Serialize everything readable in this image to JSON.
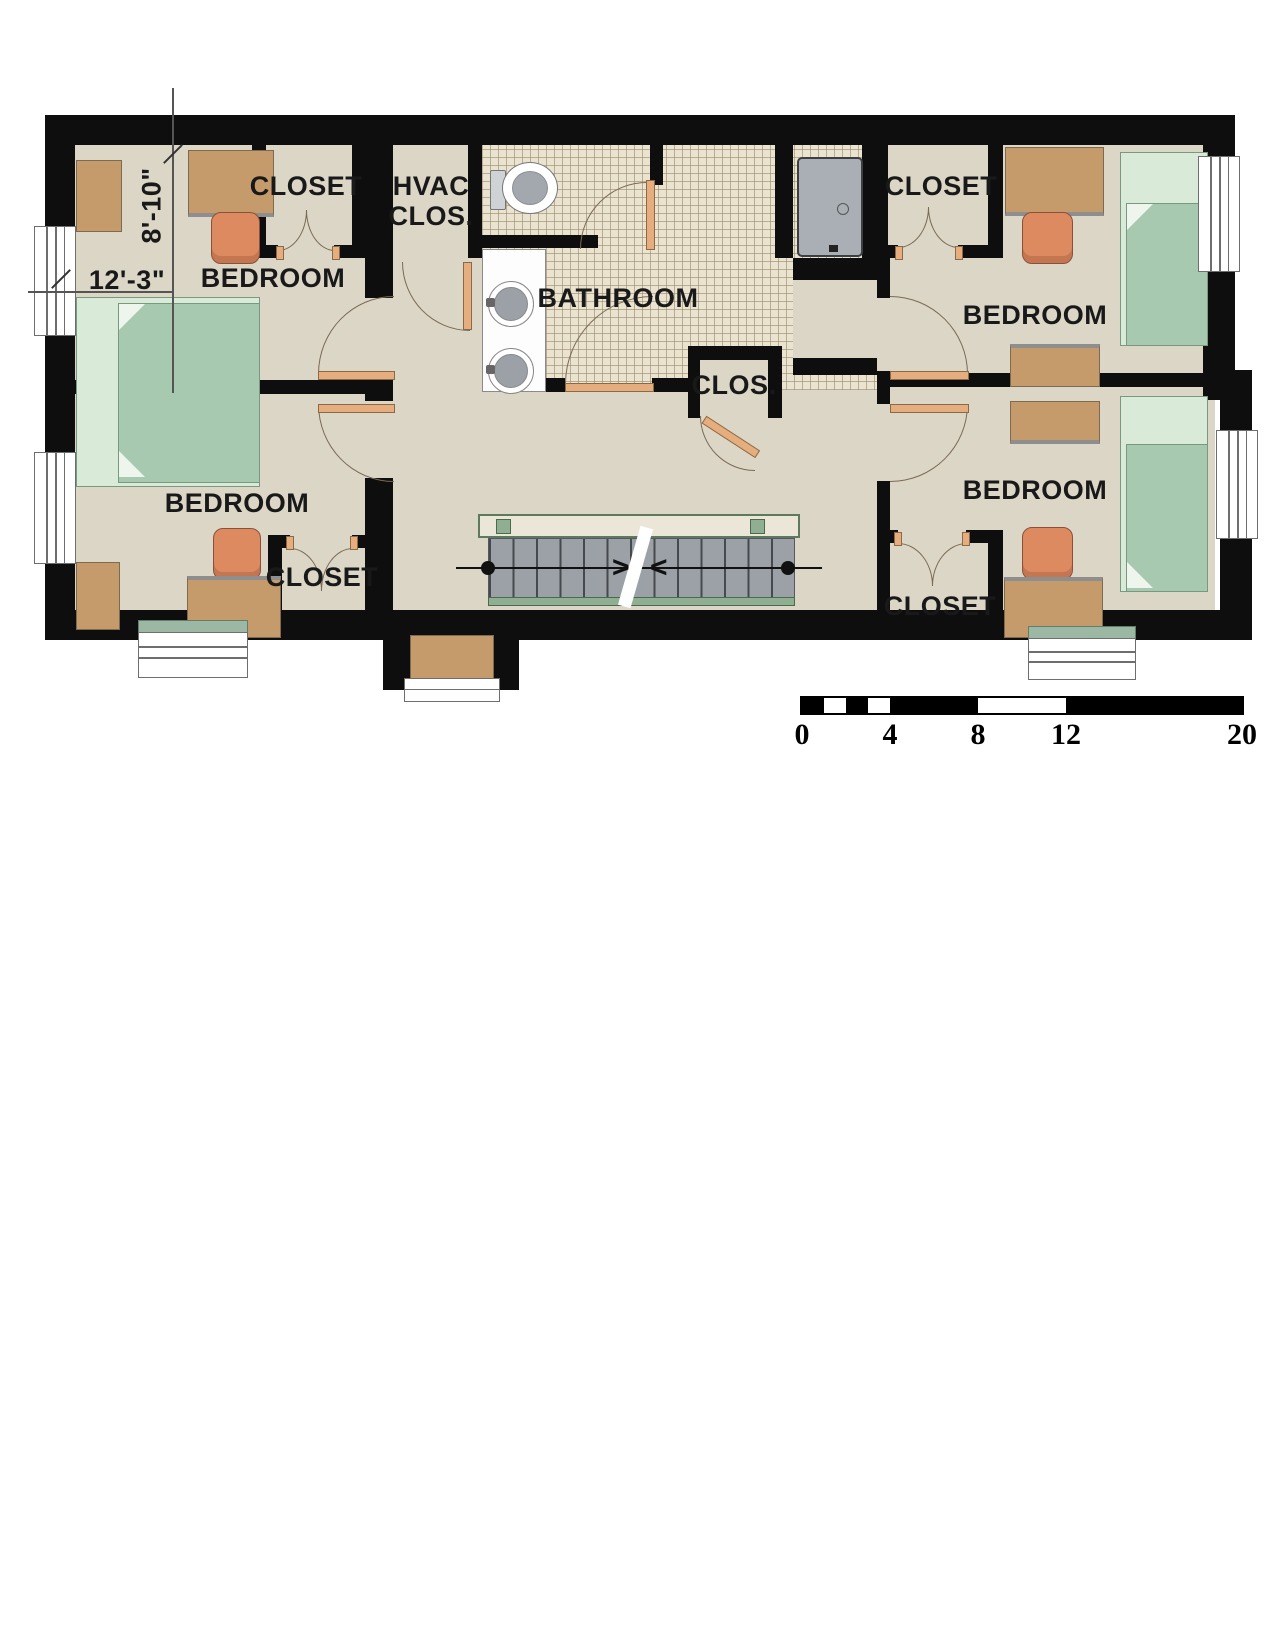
{
  "theme": {
    "wall": "#0e0e0e",
    "floor": "#dcd6c7",
    "tile": "#eae3d0",
    "bedlight": "#d9ebd8",
    "beddark": "#a7c9b0",
    "bedborder": "#79997e",
    "desk": "#c69b6c",
    "chair": "#de8a61",
    "chairborder": "#8a513a",
    "door": "#e6ae7e",
    "doorborder": "#8a6a45",
    "stair": "#9ba1a6",
    "railfill": "#ece6d8",
    "railborder": "#5d7a5f",
    "post": "#8fae92",
    "sill": "#9cb7a4",
    "arc": "#7a6a55"
  },
  "rooms": {
    "bedroom_tl": "BEDROOM",
    "bedroom_bl": "BEDROOM",
    "bedroom_tr": "BEDROOM",
    "bedroom_br": "BEDROOM",
    "closet_tl": "CLOSET",
    "closet_bl": "CLOSET",
    "closet_tr": "CLOSET",
    "closet_br": "CLOSET",
    "hvac_line1": "HVAC",
    "hvac_line2": "CLOS.",
    "bathroom": "BATHROOM",
    "hall_closet": "CLOS."
  },
  "dimensions": {
    "room_width": "12'-3\"",
    "room_depth": "8'-10\""
  },
  "scale_bar": {
    "tick_labels": [
      "0",
      "4",
      "8",
      "12",
      "20"
    ]
  },
  "stairs": {
    "break_marks": [
      ">",
      "<"
    ]
  },
  "fixtures": [
    "toilet-icon",
    "sink-icon",
    "shower-icon",
    "stairs-icon",
    "bed-icon",
    "desk-icon",
    "chair-icon",
    "window-icon",
    "door-icon"
  ]
}
